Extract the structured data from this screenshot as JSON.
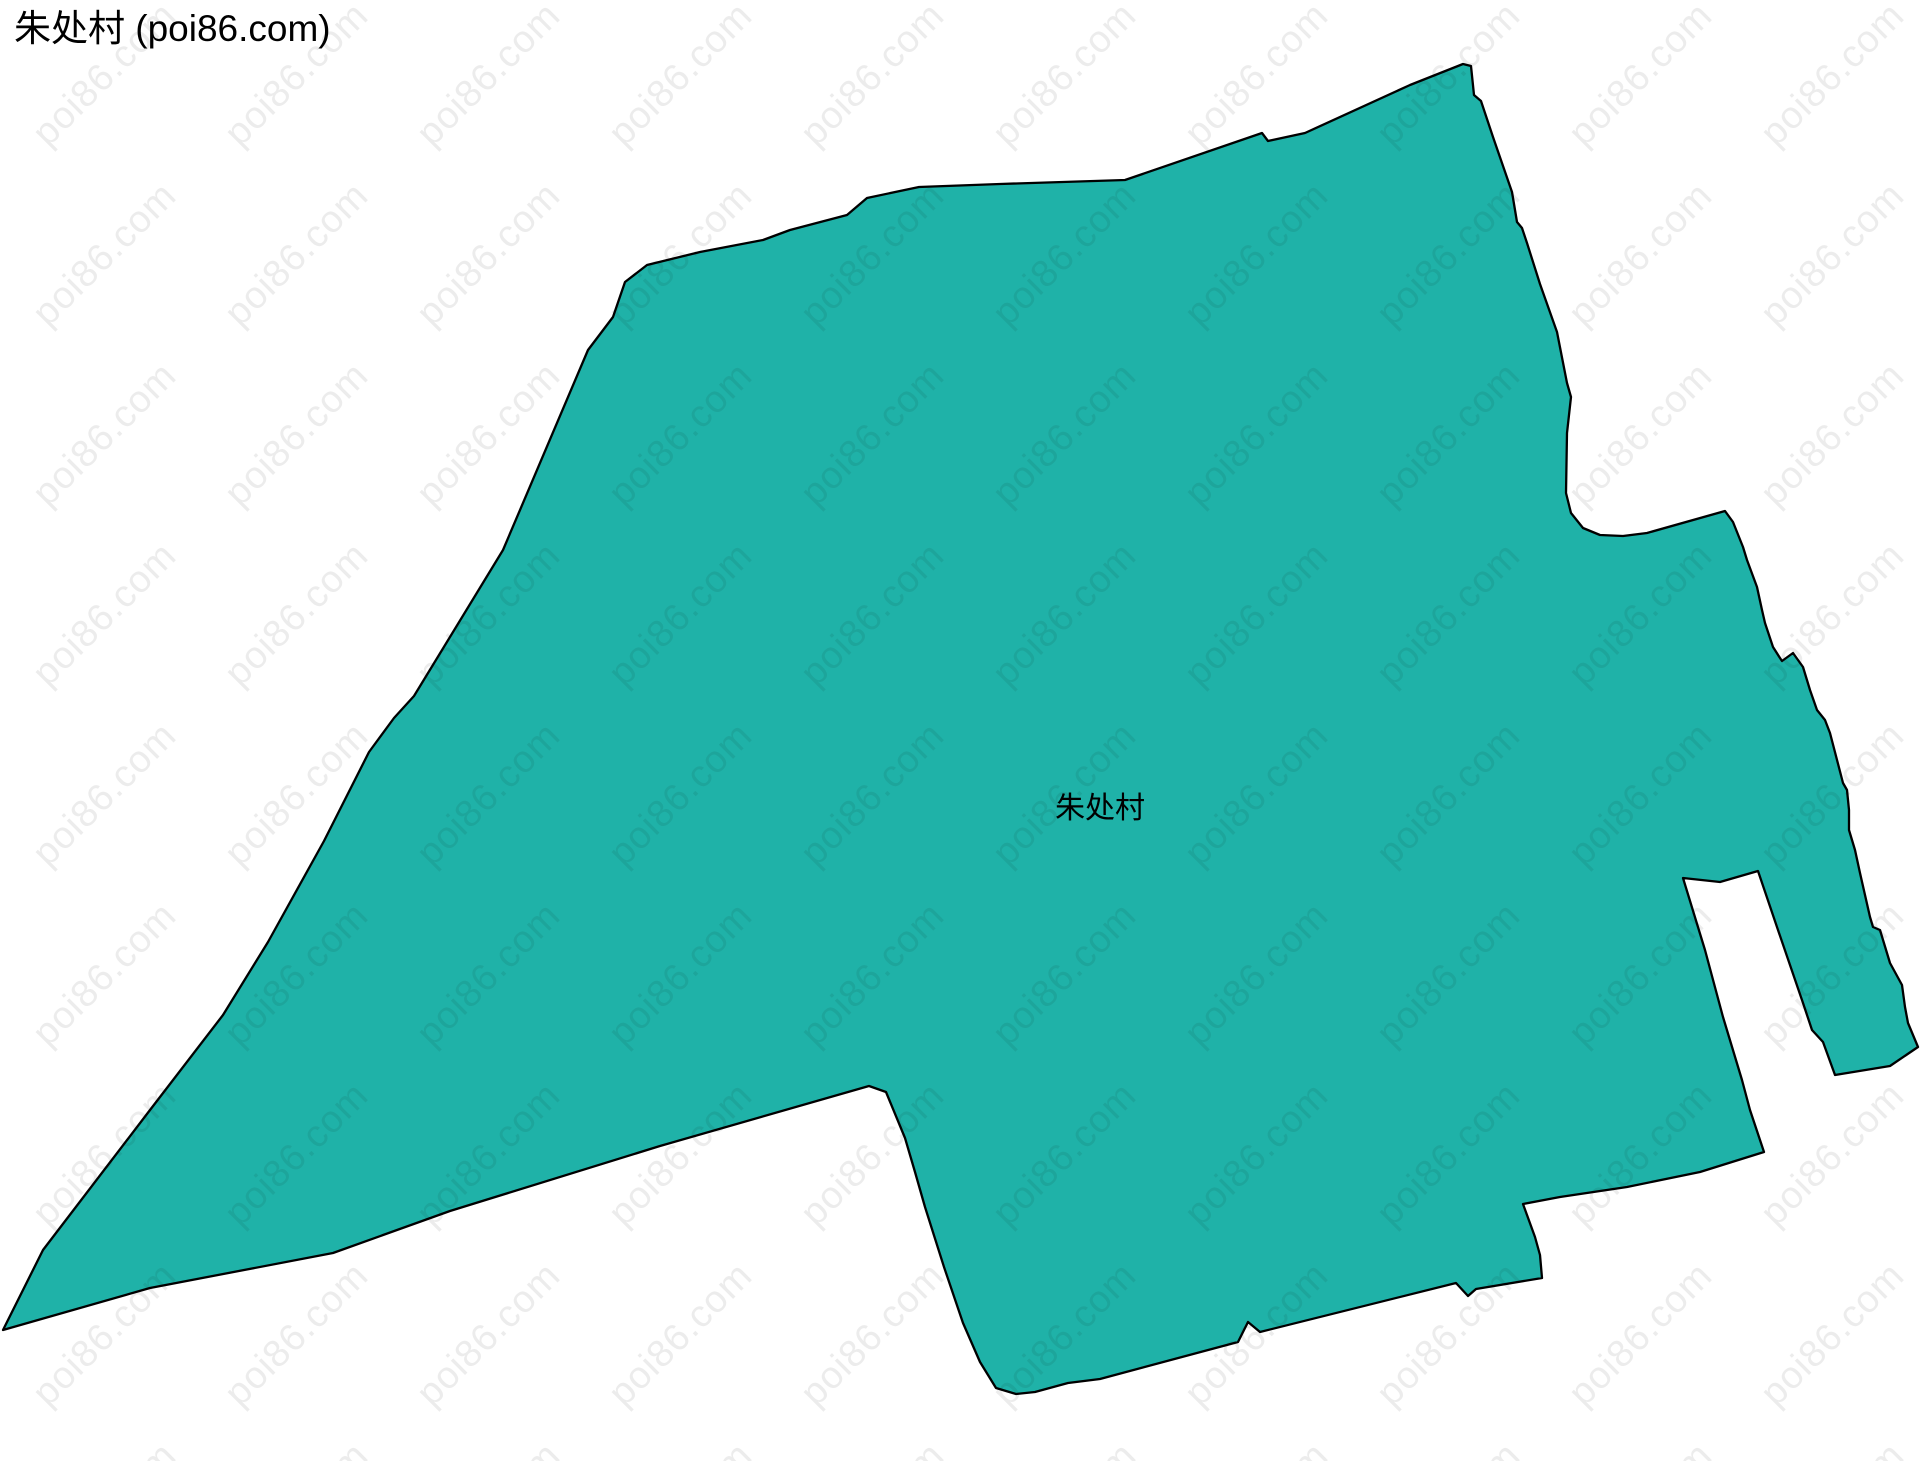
{
  "page": {
    "title": "朱处村 (poi86.com)"
  },
  "map": {
    "region_label": "朱处村",
    "label_x": 1100,
    "label_y": 818,
    "fill_color": "#1fb2a8",
    "border_color": "#000000",
    "polygon_points": "3,1330 43,1250 150,1110 223,1015 268,942 324,841 369,752 394,718 414,696 503,550 588,350 613,317 625,282 647,265 700,252 763,240 790,230 847,215 867,198 919,187 1000,184 1125,180 1262,133 1268,141 1305,133 1410,85 1463,64 1471,66 1474,95 1481,101 1493,137 1512,192 1517,222 1522,228 1527,243 1540,284 1557,332 1567,383 1571,397 1567,433 1566,493 1571,513 1583,528 1600,535 1623,536 1647,533 1725,511 1733,522 1743,547 1747,560 1757,587 1762,610 1765,623 1773,647 1780,658 1782,661 1793,653 1803,667 1810,690 1817,710 1825,720 1830,733 1843,783 1847,790 1849,810 1849,830 1855,850 1860,873 1870,917 1873,927 1880,930 1890,963 1902,985 1905,1007 1908,1023 1918,1047 1890,1066 1835,1075 1823,1042 1812,1030 1803,1003 1778,930 1758,871 1720,882 1683,878 1705,950 1723,1017 1742,1080 1750,1110 1760,1140 1764,1152 1700,1172 1627,1187 1560,1197 1523,1204 1535,1237 1540,1255 1542,1278 1476,1289 1468,1296 1456,1283 1260,1332 1248,1322 1238,1342 1100,1379 1068,1383 1035,1392 1016,1394 996,1388 980,1362 963,1323 944,1267 925,1207 915,1172 905,1138 886,1092 869,1086 660,1146 450,1211 333,1253 150,1288"
  },
  "watermark": {
    "text": "poi86.com",
    "color": "#000000",
    "opacity": 0.075,
    "tile_w": 192,
    "tile_h": 180,
    "font_size": 38
  }
}
